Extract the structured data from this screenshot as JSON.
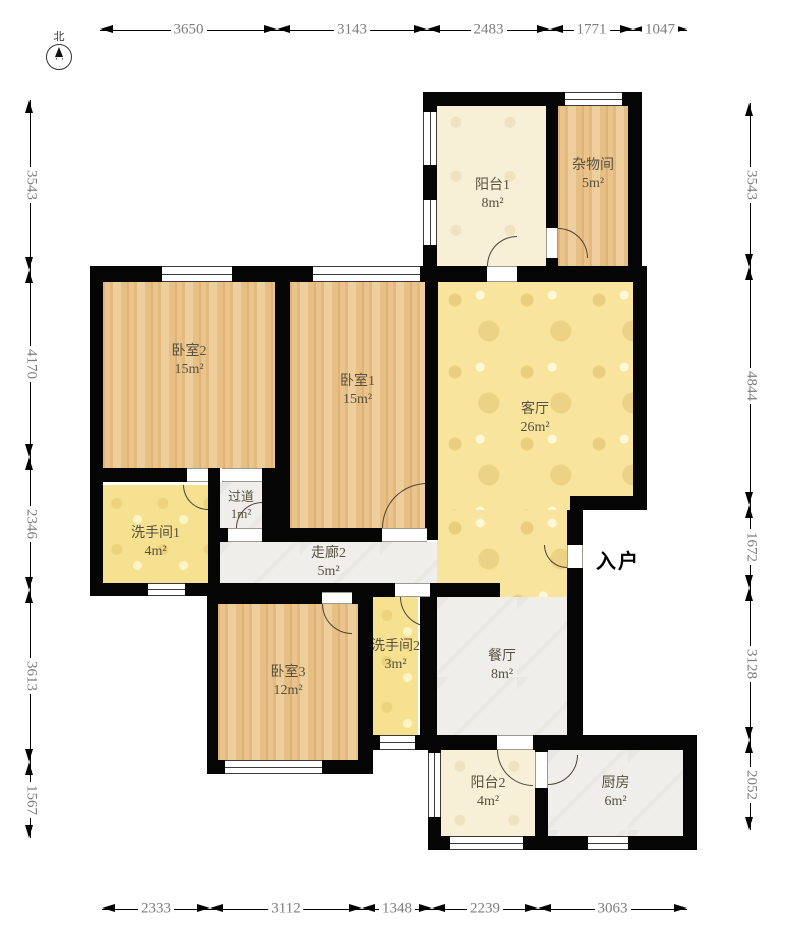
{
  "compass": {
    "north_label": "北"
  },
  "entry_label": "入户",
  "rooms": [
    {
      "id": "balcony1",
      "name": "阳台1",
      "area": "8m²"
    },
    {
      "id": "storage",
      "name": "杂物间",
      "area": "5m²"
    },
    {
      "id": "bedroom2",
      "name": "卧室2",
      "area": "15m²"
    },
    {
      "id": "bedroom1",
      "name": "卧室1",
      "area": "15m²"
    },
    {
      "id": "living",
      "name": "客厅",
      "area": "26m²"
    },
    {
      "id": "aisle",
      "name": "过道",
      "area": "1m²"
    },
    {
      "id": "bath1",
      "name": "洗手间1",
      "area": "4m²"
    },
    {
      "id": "corridor2",
      "name": "走廊2",
      "area": "5m²"
    },
    {
      "id": "bedroom3",
      "name": "卧室3",
      "area": "12m²"
    },
    {
      "id": "bath2",
      "name": "洗手间2",
      "area": "3m²"
    },
    {
      "id": "dining",
      "name": "餐厅",
      "area": "8m²"
    },
    {
      "id": "balcony2",
      "name": "阳台2",
      "area": "4m²"
    },
    {
      "id": "kitchen",
      "name": "厨房",
      "area": "6m²"
    }
  ],
  "dimensions": {
    "top": [
      "3650",
      "3143",
      "2483",
      "1771",
      "1047"
    ],
    "bottom": [
      "2333",
      "3112",
      "1348",
      "2239",
      "3063"
    ],
    "left": [
      "3543",
      "4170",
      "2346",
      "3613",
      "1567"
    ],
    "right": [
      "3543",
      "4844",
      "1672",
      "3128",
      "2052"
    ]
  },
  "colors": {
    "wall": "#050505",
    "wood_floor": "#e8c28a",
    "living_floor": "#f8e49c",
    "bath_floor": "#f6e190",
    "balcony_floor": "#f7efd6",
    "marble_floor": "#efeeea",
    "dim_text": "#7d7d7d"
  }
}
